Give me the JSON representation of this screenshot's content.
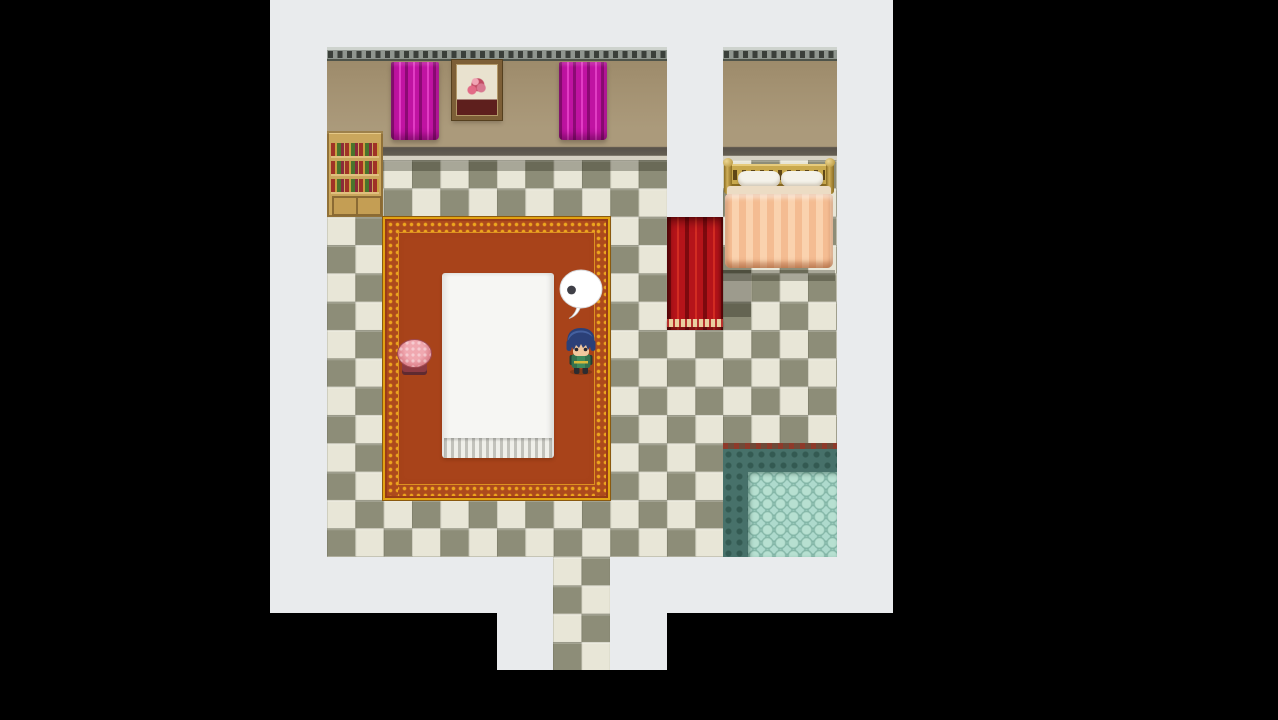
{
  "scene": {
    "view": "top-down-interior",
    "style": "rpg-maker-room",
    "balloon": {
      "kind": "thought-dots",
      "dots_visible": 1
    },
    "player": {
      "facing": "down",
      "action": "standing",
      "hair": "blue"
    },
    "entities": [
      "bookshelf",
      "magenta-curtain-left",
      "framed-flower-picture",
      "magenta-curtain-right",
      "double-bed",
      "red-doorway-curtain",
      "ornate-carpet",
      "white-table",
      "pink-stool",
      "player-character",
      "thought-balloon",
      "bath-pool",
      "south-exit-corridor"
    ]
  },
  "colors": {
    "bg-black": "#000000",
    "outside-white": "#e9ebed",
    "tile-light": "#e8e6d7",
    "tile-dark": "#8d8d78",
    "wall-tan": "#ab9a7b",
    "trim-gray": "#8f968f",
    "trim-dark": "#3a3f3a",
    "shelf-wood": "#caa75d",
    "curtain-magenta": "#c013a2",
    "curtain-red": "#b5141a",
    "blanket-peach": "#f4bc92",
    "carpet-field": "#a8431a",
    "carpet-gold": "#e2a313",
    "table-white": "#f6f6f3",
    "stool-pink": "#e2858d",
    "pool-lip": "#6d4a38",
    "pool-dark": "#47716a",
    "pool-cobble": "#98c9ba",
    "balloon-white": "#ffffff",
    "balloon-dot": "#3f3f47",
    "hair-blue": "#2b4078"
  }
}
